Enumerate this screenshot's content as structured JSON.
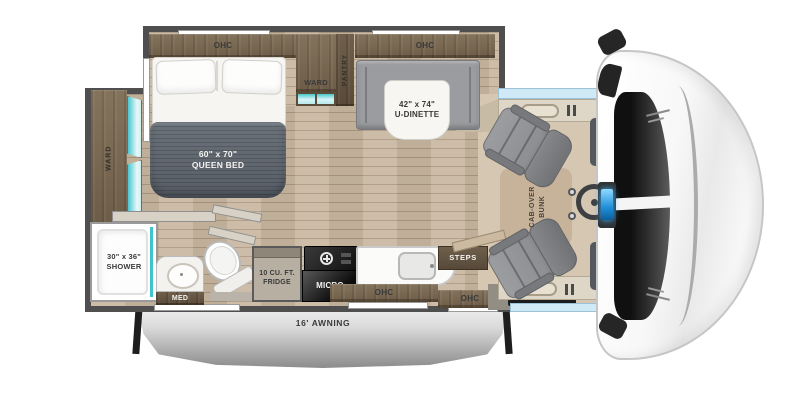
{
  "plan": {
    "bedroom": {
      "ohc": "OHC",
      "ward_top": "WARD",
      "pantry": "PANTRY",
      "ward_left": "WARD",
      "bed_size": "60\" x 70\"",
      "bed_type": "QUEEN BED"
    },
    "dinette": {
      "ohc": "OHC",
      "size": "42\" x 74\"",
      "name": "U-DINETTE"
    },
    "bathroom": {
      "shower_size": "30\" x 36\"",
      "shower_name": "SHOWER",
      "med": "MED"
    },
    "kitchen": {
      "fridge_size": "10 CU. FT.",
      "fridge_name": "FRIDGE",
      "micro": "MICRO",
      "ohc_1": "OHC",
      "ohc_2": "OHC",
      "steps": "STEPS"
    },
    "entry": {
      "tv": "TV"
    },
    "cab": {
      "bunk_line1": "CAB-OVER",
      "bunk_line2": "BUNK"
    },
    "exterior": {
      "awning": "16' AWNING"
    }
  },
  "colors": {
    "wall": "#4f4f4f",
    "cabinet_wood": "#7a6a54",
    "floor_wood": "#c9b7a0",
    "teal_accent": "#49c7cf",
    "bed_blanket": "#5d646d",
    "seat_gray": "#8e9093",
    "window_blue": "#cfeaf6",
    "awning_silver": "#b9b9b9",
    "dash_screen_blue": "#1f8fd8"
  }
}
